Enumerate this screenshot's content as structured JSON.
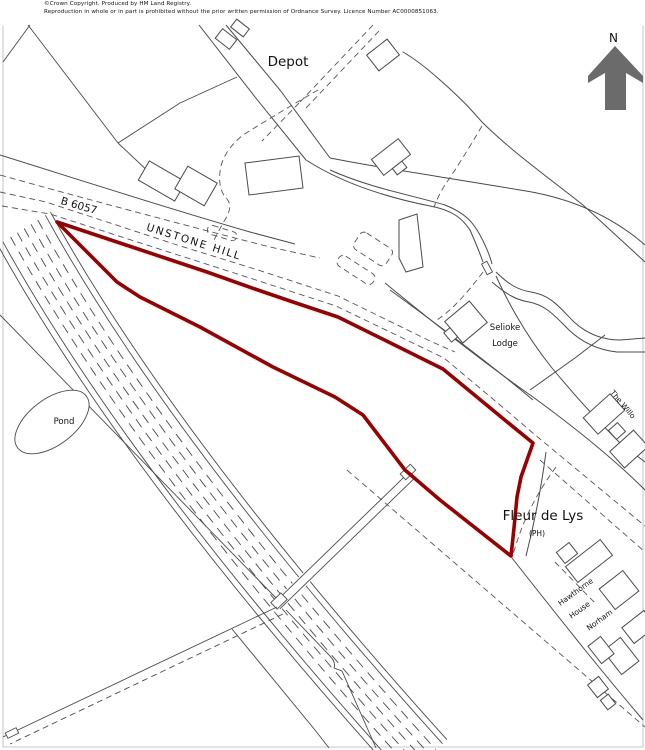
{
  "header": {
    "copyright_line1": "©Crown Copyright.  Produced by HM Land Registry.",
    "copyright_line2": "Reproduction in whole or in part is prohibited without the prior written permission of Ordnance Survey. Licence Number AC0000851063."
  },
  "compass": {
    "label": "N"
  },
  "map_labels": {
    "depot": "Depot",
    "road_number": "B 6057",
    "road_name": "UNSTONE HILL",
    "selioke_line1": "Selioke",
    "selioke_line2": "Lodge",
    "pond": "Pond",
    "pub_name": "Fleur de Lys",
    "pub_type": "(PH)",
    "hawthorne_line1": "Hawthorne",
    "hawthorne_line2": "House",
    "norham": "Norham",
    "the_willows": "The Willo"
  },
  "colors": {
    "boundary_red": "#990000",
    "map_line": "#4a4a4a",
    "compass_gray": "#6b6b6b"
  }
}
